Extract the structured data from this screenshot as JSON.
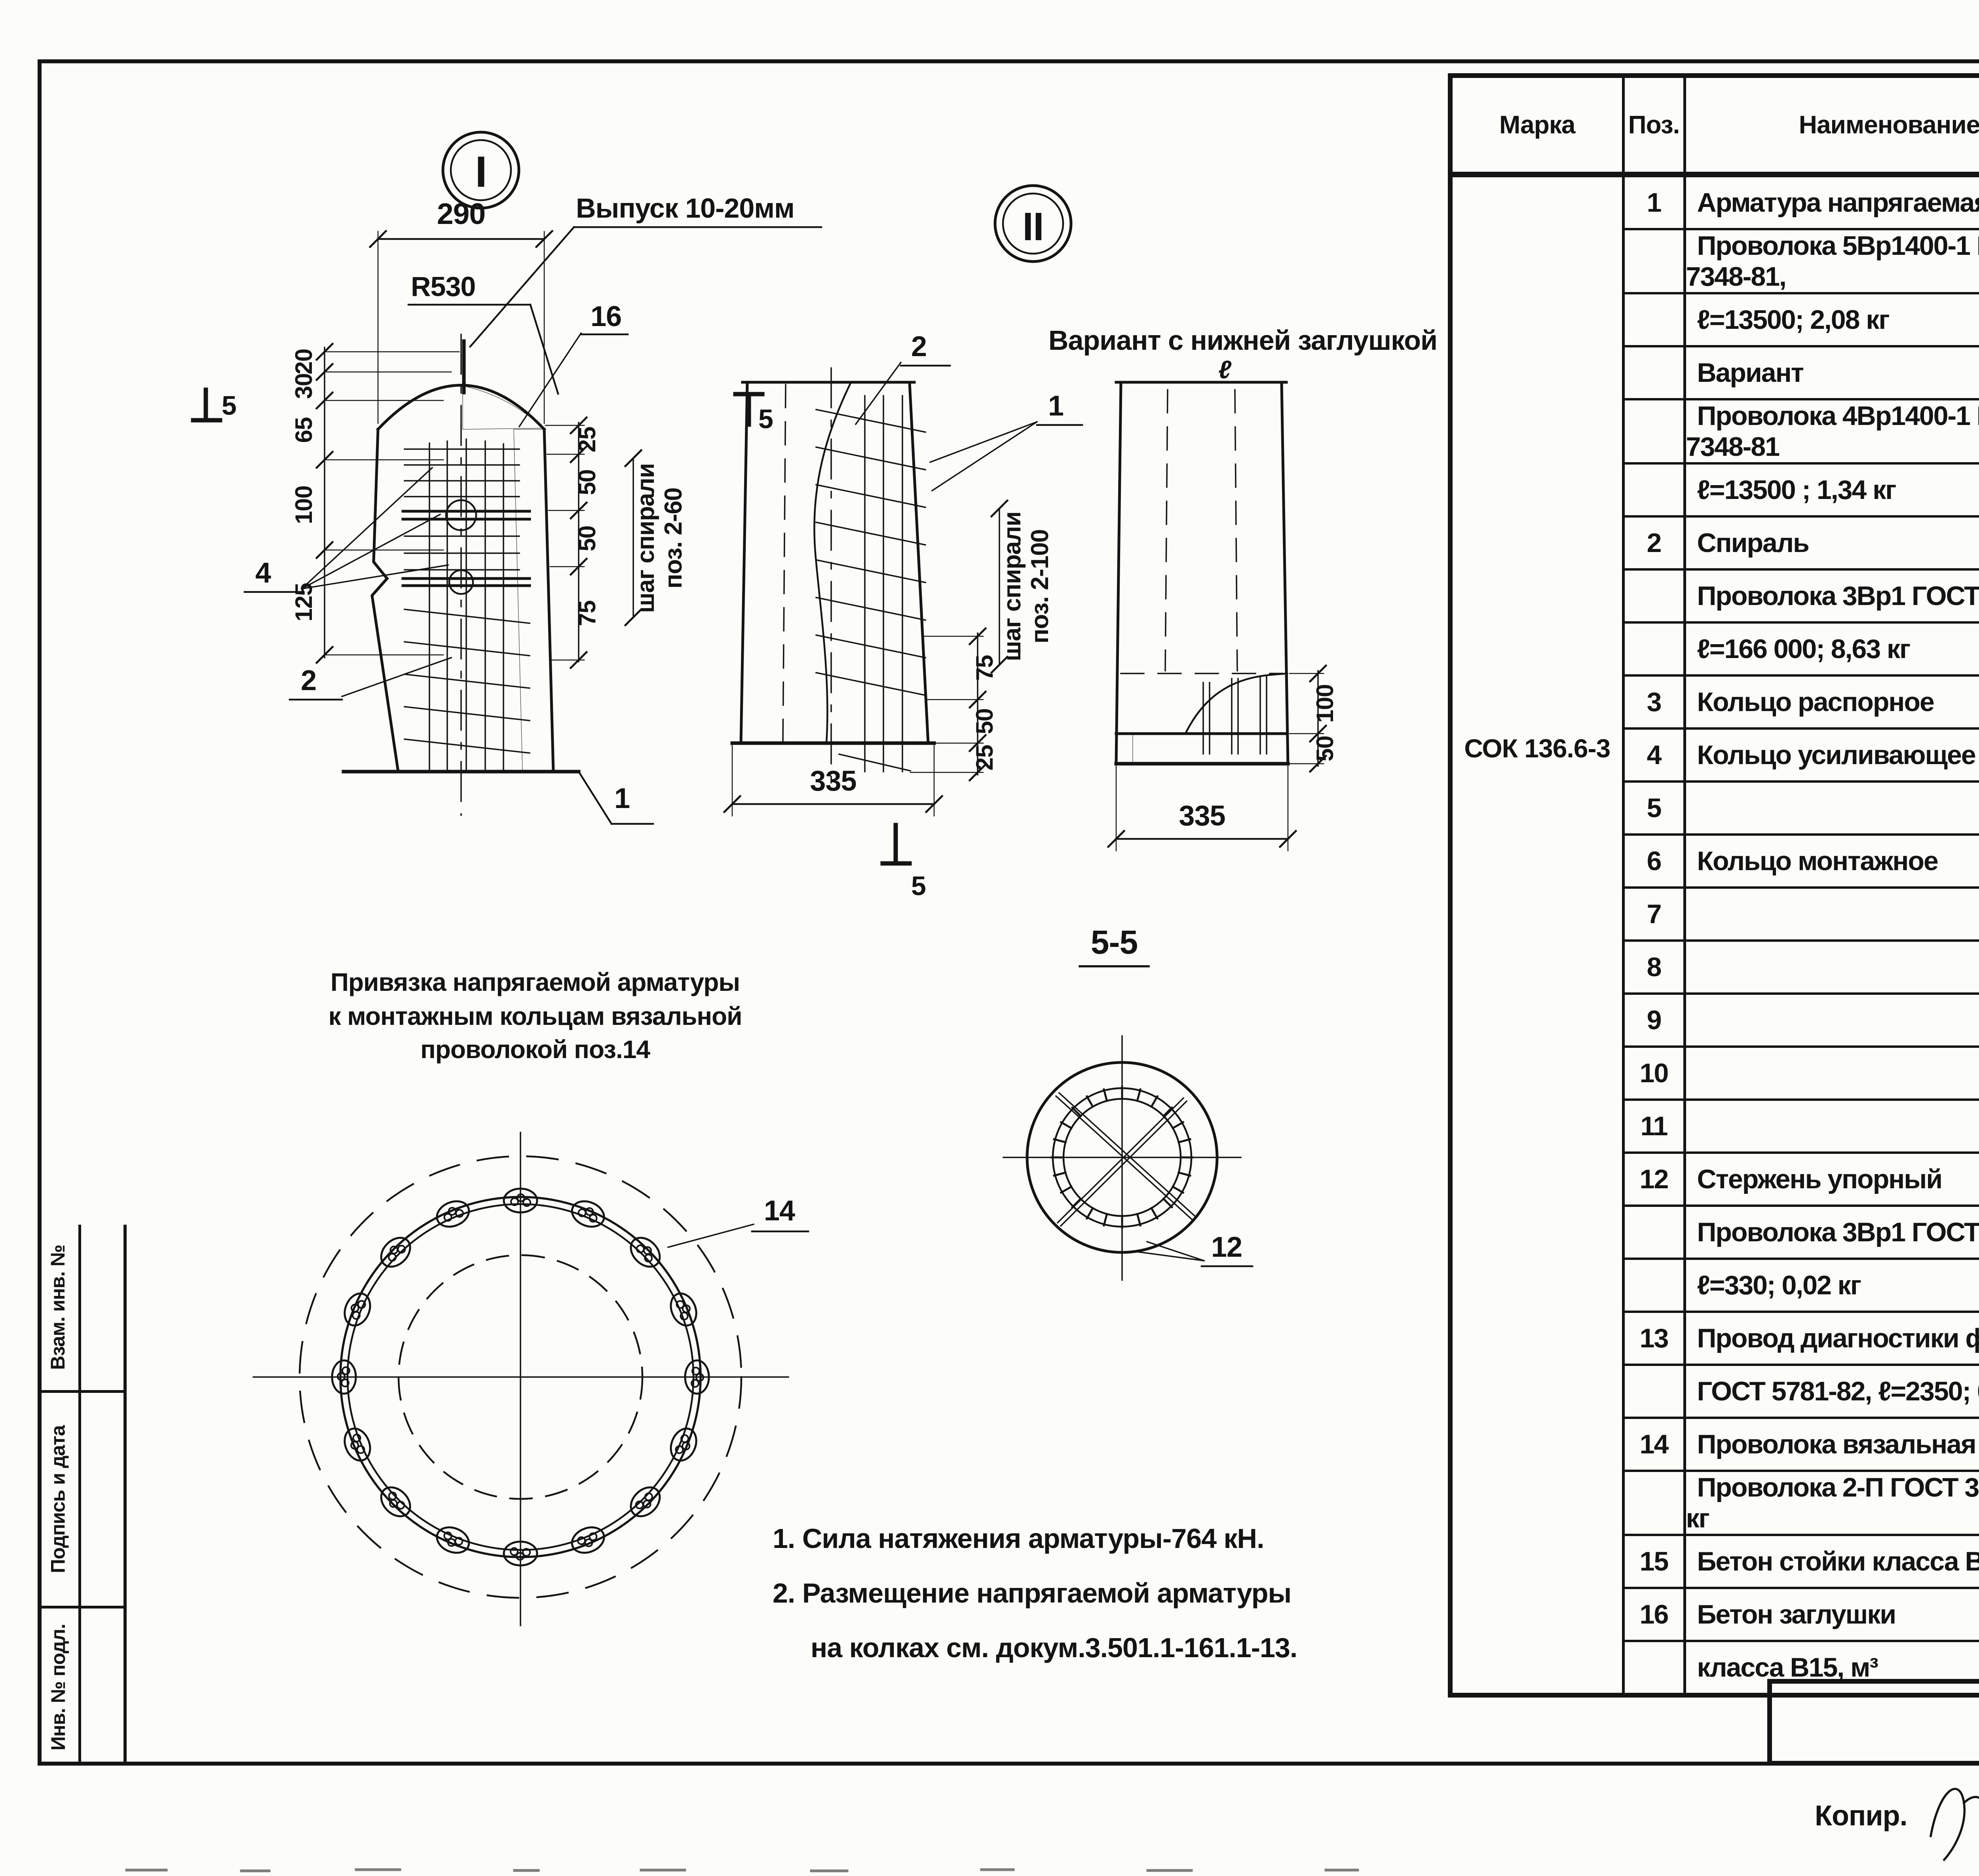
{
  "page_number": "24",
  "stamp": {
    "cells": [
      "Взам. инв. №",
      "Подпись и дата",
      "Инв. № подл."
    ]
  },
  "drawing1": {
    "label": "I",
    "dim_top": "290",
    "radius_label": "R530",
    "release_note": "Выпуск 10-20мм",
    "leader_16": "16",
    "leader_4": "4",
    "leader_2": "2",
    "leader_1": "1",
    "left_dims": [
      "20",
      "30",
      "65",
      "100",
      "125"
    ],
    "right_dims": [
      "25",
      "50",
      "50",
      "75"
    ],
    "section_mark": "5",
    "spiral_note_line1": "шаг спирали",
    "spiral_note_line2": "поз. 2-60"
  },
  "drawing2": {
    "label": "II",
    "leader_2": "2",
    "leader_1": "1",
    "spiral_note_line1": "шаг спирали",
    "spiral_note_line2": "поз. 2-100",
    "right_dims": [
      "75",
      "50",
      "25"
    ],
    "dim_bottom": "335",
    "section_mark": "5"
  },
  "drawing3": {
    "title": "Вариант с нижней заглушкой",
    "top_mark": "ℓ",
    "right_dims": [
      "100",
      "50"
    ],
    "dim_bottom": "335"
  },
  "section55": {
    "title": "5-5",
    "leader_12": "12"
  },
  "binding_view": {
    "caption": [
      "Привязка напрягаемой арматуры",
      "к монтажным кольцам вязальной",
      "проволокой поз.14"
    ],
    "leader_14": "14"
  },
  "notes": [
    "1. Сила натяжения арматуры-764 кН.",
    "2. Размещение напрягаемой арматуры",
    "на колках см. докум.3.501.1-161.1-13."
  ],
  "spec_table": {
    "headers": {
      "marka": "Марка",
      "poz": "Поз.",
      "name": "Наименование",
      "qty": "Кол.",
      "doc_line1": "Обозначение",
      "doc_line2": "документа",
      "mass_line1": "Масса,",
      "mass_line2": "кг"
    },
    "marka_value": "СОК 136.6-3",
    "mass_value": "1978",
    "rows": [
      {
        "poz": "1",
        "name": "Арматура напрягаемая",
        "qty": "",
        "doc": "",
        "sep": "full"
      },
      {
        "poz": "",
        "name": "Проволока 5Вр1400-1 ГОСТ 7348-81,",
        "qty": "",
        "doc": "",
        "sep": "full"
      },
      {
        "poz": "",
        "name": "ℓ=13500;  2,08 кг",
        "qty": "48",
        "doc": "без черт.",
        "sep": "full"
      },
      {
        "poz": "",
        "name": "Вариант",
        "qty": "",
        "doc": "",
        "sep": "full"
      },
      {
        "poz": "",
        "name": "Проволока 4Вр1400-1 ГОСТ 7348-81",
        "qty": "",
        "doc": "",
        "sep": "full"
      },
      {
        "poz": "",
        "name": "ℓ=13500 ;  1,34 кг",
        "qty": "64",
        "doc": "без черт.",
        "sep": "full"
      },
      {
        "poz": "2",
        "name": "Спираль",
        "qty": "",
        "doc": "",
        "sep": "full"
      },
      {
        "poz": "",
        "name": "Проволока 3Вр1 ГОСТ 6727-80,",
        "qty": "",
        "doc": "",
        "sep": "full"
      },
      {
        "poz": "",
        "name": "ℓ=166 000;  8,63 кг",
        "qty": "1",
        "doc": "без черт.",
        "sep": "full"
      },
      {
        "poz": "3",
        "name": "Кольцо распорное",
        "name2": "КР1",
        "qty": "1",
        "doc": "3.501.1-161.1-14",
        "sep": "full"
      },
      {
        "poz": "4",
        "name": "Кольцо усиливающее",
        "name2": "КУ1",
        "qty": "3",
        "doc": "3.501.1-161.1-15",
        "sep": "short"
      },
      {
        "poz": "5",
        "name": "",
        "name2": "КУ 2",
        "qty": "2",
        "doc": "",
        "sep": "short"
      },
      {
        "poz": "6",
        "name": "Кольцо монтажное",
        "name2": "КМ 2",
        "qty": "1",
        "doc": "3.501.1-161.1-16",
        "sep": "short"
      },
      {
        "poz": "7",
        "name": "",
        "name2": "КМ 5",
        "qty": "1",
        "doc": "",
        "sep": "short"
      },
      {
        "poz": "8",
        "name": "",
        "name2": "КМ6",
        "qty": "1",
        "doc": "",
        "sep": "short"
      },
      {
        "poz": "9",
        "name": "",
        "name2": "КМ8",
        "qty": "1",
        "doc": "",
        "sep": "short"
      },
      {
        "poz": "10",
        "name": "",
        "name2": "КМ 9",
        "qty": "1",
        "doc": "",
        "sep": "short"
      },
      {
        "poz": "11",
        "name": "",
        "name2": "КМ7",
        "qty": "1",
        "doc": "",
        "sep": "full"
      },
      {
        "poz": "12",
        "name": "Стержень упорный",
        "qty": "",
        "doc": "",
        "sep": "full"
      },
      {
        "poz": "",
        "name": "Проволока 3Вр1 ГОСТ 6727-80,",
        "qty": "",
        "doc": "",
        "sep": "full"
      },
      {
        "poz": "",
        "name": "ℓ=330;  0,02 кг",
        "qty": "2",
        "doc": "без черт.",
        "sep": "full"
      },
      {
        "poz": "13",
        "name": "Провод диагностики ф6 АI",
        "qty": "",
        "doc": "",
        "sep": "full"
      },
      {
        "poz": "",
        "name": "ГОСТ 5781-82, ℓ=2350;  0,52 кг",
        "qty": "1",
        "doc": "3.501.1-161.1-3",
        "sep": "full"
      },
      {
        "poz": "14",
        "name": "Проволока вязальная",
        "qty": "",
        "doc": "",
        "sep": "full"
      },
      {
        "poz": "",
        "name": "Проволока 2-П ГОСТ 3282-74, кг",
        "qty": "0,57",
        "doc": "без черт.",
        "sep": "full"
      },
      {
        "poz": "15",
        "name": "Бетон стойки класса В40, м³",
        "qty": "0,79",
        "doc": "",
        "sep": "full"
      },
      {
        "poz": "16",
        "name": "Бетон заглушки",
        "qty": "",
        "doc": "",
        "sep": "full"
      },
      {
        "poz": "",
        "name": "класса В15,  м³",
        "qty": "0,004",
        "doc": "",
        "sep": "full"
      }
    ]
  },
  "title_block": {
    "doc_number": "3.501.1-161.1-3",
    "sheet_label": "Лист",
    "sheet_number": "2"
  },
  "footer": {
    "copy_label": "Копир.",
    "order_number": "24990",
    "page": "25",
    "format": "Формат А3"
  }
}
